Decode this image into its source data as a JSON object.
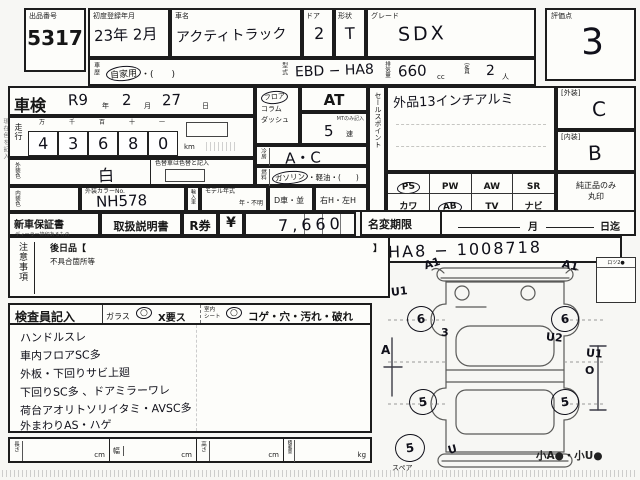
{
  "page": {
    "margin_note": "現在色を記入"
  },
  "header": {
    "lot_label": "出品番号",
    "lot_number": "5317",
    "first_reg_label": "初度登録年月",
    "first_reg_value": "23年 2月",
    "car_name_label": "車名",
    "car_name_value": "アクティトラック",
    "door_label": "ドア",
    "door_value": "2",
    "shape_label": "形状",
    "shape_value": "T",
    "grade_label": "グレード",
    "grade_value": "SDX",
    "score_label": "評価点",
    "score_value": "3",
    "history_label": "車歴",
    "history_circled": "自家用",
    "history_rest": "・(　　)",
    "model_code_label": "型式",
    "model_code_value": "EBD − HA8",
    "displacement_label": "排気量",
    "displacement_value": "660",
    "displacement_unit": "cc",
    "capacity_label": "定員",
    "capacity_value": "2",
    "capacity_unit": "人"
  },
  "inspection": {
    "shaken_label": "車検",
    "shaken_year": "R9",
    "year_unit": "年",
    "shaken_month": "2",
    "month_unit": "月",
    "shaken_day": "27",
    "day_unit": "日"
  },
  "mileage": {
    "label": "走行",
    "headers": [
      "万",
      "千",
      "百",
      "十",
      "一"
    ],
    "digits": [
      "4",
      "3",
      "6",
      "8",
      "0"
    ],
    "unit": "km"
  },
  "colors": {
    "exterior_label": "外装色",
    "exterior_value": "白",
    "color_change_note": "色替車は色替と記入",
    "interior_label": "内装色",
    "color_no_label": "外装カラーNo.",
    "color_no_value": "NH578",
    "import_label": "輸入車",
    "model_year_label": "モデル年式",
    "model_year_value": "年・不明",
    "d_car": "D車・並",
    "handle": "右H・左H"
  },
  "drivetrain": {
    "shift_options": [
      "フロア",
      "コラム",
      "ダッシュ"
    ],
    "transmission": "AT",
    "mt_note": "MTのみ記入",
    "gears_value": "5",
    "gears_unit": "速",
    "aircon_label": "冷房",
    "aircon_value": "A・C",
    "fuel_label": "燃料",
    "fuel_circled": "ガソリン",
    "fuel_rest": "・軽油・(　　)"
  },
  "sales_point": {
    "label": "セールスポイント",
    "value": "外品13インチアルミ"
  },
  "ratings": {
    "exterior_label": "[外装]",
    "exterior_grade": "C",
    "interior_label": "[内装]",
    "interior_grade": "B",
    "genuine_note_1": "純正品のみ",
    "genuine_note_2": "丸印"
  },
  "equipment": {
    "row1": [
      {
        "code": "PS",
        "sub": "(パワステ)",
        "circled": true
      },
      {
        "code": "PW",
        "sub": "(パワーウインド)",
        "circled": false
      },
      {
        "code": "AW",
        "sub": "(アルミホイル)",
        "circled": false
      },
      {
        "code": "SR",
        "sub": "(サンルーフ)",
        "circled": false
      }
    ],
    "row2": [
      {
        "code": "カワ",
        "sub": "(レザーシート)",
        "circled": false
      },
      {
        "code": "AB",
        "sub": "(エアバッグ)",
        "circled": true
      },
      {
        "code": "TV",
        "sub": "(液晶TV)",
        "circled": false
      },
      {
        "code": "ナビ",
        "sub": "(ナビゲーション)",
        "circled": false
      }
    ]
  },
  "documents": {
    "warranty_label": "新車保証書",
    "warranty_sub": "ディーラー捺印あるもの",
    "manual_label": "取扱説明書",
    "r_ticket_label": "R券",
    "currency": "¥",
    "amount": "7,660"
  },
  "name_change": {
    "label": "名変期限",
    "month_unit": "月",
    "until": "日迄"
  },
  "chassis": {
    "label": "車台No",
    "value": "HA8 − 1008718"
  },
  "cautions": {
    "label": "注意事項",
    "later_open": "後日品【",
    "later_close": "】",
    "defects": "不具合箇所等"
  },
  "inspector": {
    "label": "検査員記入",
    "glass_label": "ガラス",
    "glass_mark": "○",
    "glass_options": "X要ス",
    "seat_label_1": "室内",
    "seat_label_2": "シート",
    "seat_mark": "○",
    "seat_options": "コゲ・穴・汚れ・破れ",
    "notes": [
      "ハンドルスレ",
      "車内フロアSC多",
      "外板・下回りサビ上廻",
      "下回りSC多 、ドアミラーワレ",
      "荷台アオリトソリイタミ・AVSC多",
      "外まわりAS・ハゲ"
    ]
  },
  "dimensions": {
    "length_label": "長さ",
    "width_label": "幅",
    "height_label": "高さ",
    "load_label": "積載量",
    "cm": "cm",
    "kg": "kg"
  },
  "diagram": {
    "lock_label": "ロツ2●",
    "spare_label": "スペア",
    "footnote": "小A●・小U●",
    "marks": [
      {
        "text": "A1"
      },
      {
        "text": "A1"
      },
      {
        "text": "U1"
      },
      {
        "text": "6"
      },
      {
        "text": "6"
      },
      {
        "text": "3"
      },
      {
        "text": "U2"
      },
      {
        "text": "A"
      },
      {
        "text": "U1"
      },
      {
        "text": "O"
      },
      {
        "text": "5"
      },
      {
        "text": "5"
      },
      {
        "text": "U"
      },
      {
        "text": "5"
      }
    ]
  }
}
